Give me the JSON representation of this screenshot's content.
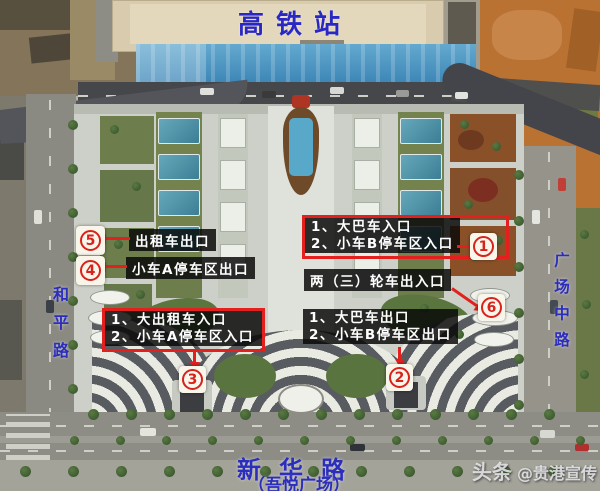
{
  "station": {
    "label": "高铁站"
  },
  "roads": {
    "left_vertical": "和平路",
    "right_vertical": "广场中路",
    "bottom": "新华路",
    "bottom_subtitle": "（吾悦广场）"
  },
  "callouts": {
    "taxi_exit": {
      "text": "出租车出口",
      "marker": "5"
    },
    "car_a_exit": {
      "text": "小车A停车区出口",
      "marker": "4"
    },
    "bus_car_b_entrance": {
      "line1": "1、大巴车入口",
      "line2": "2、小车B停车区入口",
      "marker": "1"
    },
    "two_three_wheeler": {
      "text": "两（三）轮车出入口",
      "marker": "6"
    },
    "bus_car_b_exit": {
      "line1": "1、大巴车出口",
      "line2": "2、小车B停车区出口",
      "marker": "2"
    },
    "taxi_car_a_entrance": {
      "line1": "1、大出租车入口",
      "line2": "2、小车A停车区入口",
      "marker": "3"
    }
  },
  "markers": {
    "m1": "1",
    "m2": "2",
    "m3": "3",
    "m4": "4",
    "m5": "5",
    "m6": "6"
  },
  "watermark": {
    "brand": "头条",
    "handle": "@贵港宣传"
  },
  "colors": {
    "annotation_red": "#e3201d",
    "label_background": "rgba(8,8,8,0.84)",
    "road_name_blue": "#2b2dbd",
    "canopy_blue": "#2c76ac",
    "dirt_orange": "#ba7233"
  }
}
